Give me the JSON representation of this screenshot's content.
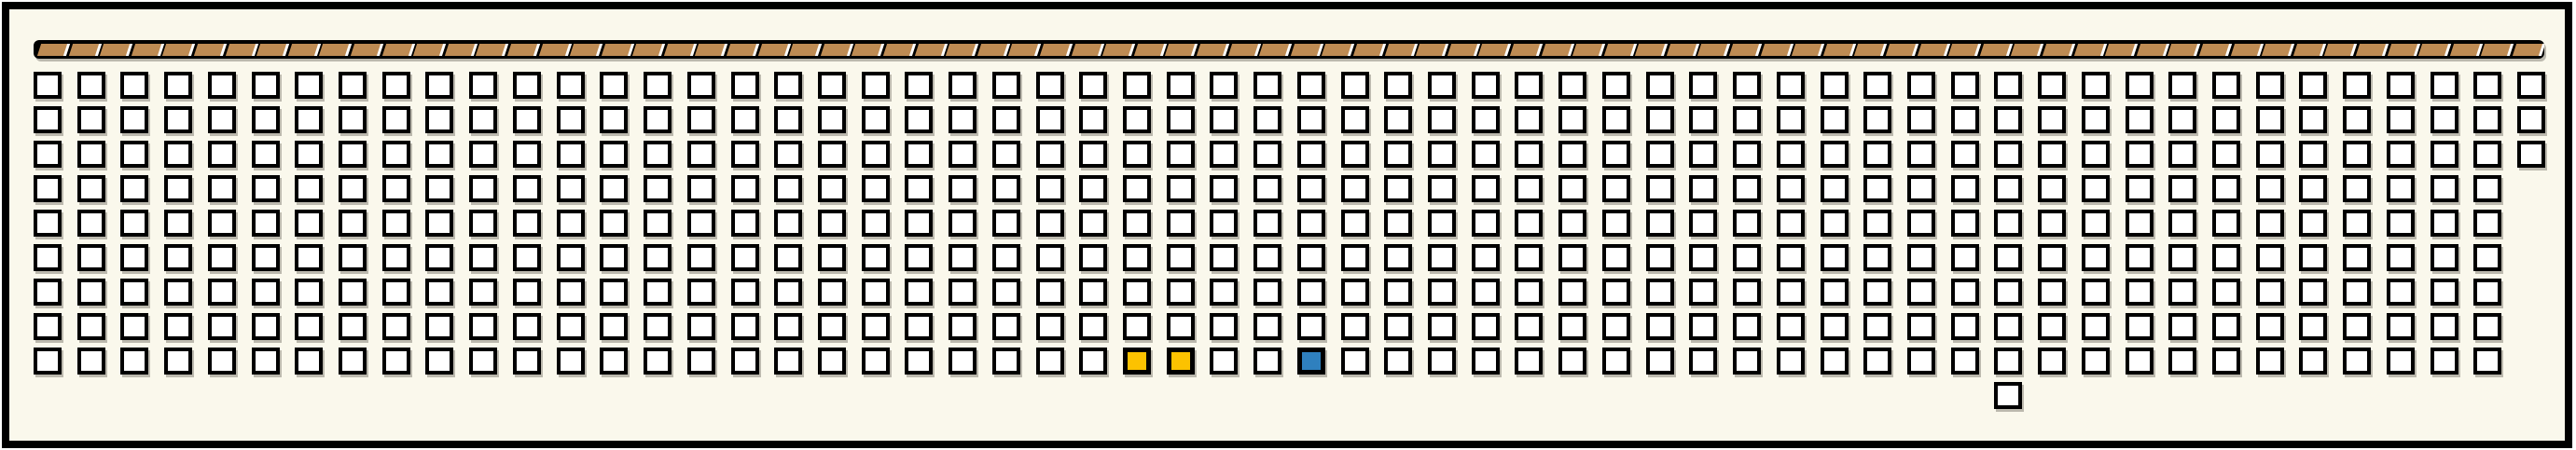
{
  "app": {
    "description": "Seat-map style grid panel with hatched stage bar and selected seats",
    "background_color": "#FFFFFF",
    "panel_color": "#FAF8EC",
    "frame_color": "#000000"
  },
  "stage_bar": {
    "segment_count": 80,
    "segment_color": "#BE8B53",
    "bar_color": "#000000",
    "separator_color": "#FFFFFF"
  },
  "seat_grid": {
    "rows": 9,
    "columns": 58,
    "row_cell_counts": [
      58,
      58,
      58,
      57,
      57,
      57,
      57,
      57,
      57
    ],
    "extra_cell": {
      "row": 10,
      "column": 46
    },
    "cell_fill": "#FFFFFF",
    "cell_border": "#000000",
    "highlighted_cells": [
      {
        "row": 9,
        "column": 26,
        "color": "#FCC200",
        "state": "selected"
      },
      {
        "row": 9,
        "column": 27,
        "color": "#FCC200",
        "state": "selected"
      },
      {
        "row": 9,
        "column": 30,
        "color": "#2F80BE",
        "state": "reserved"
      }
    ],
    "total_cells": 517
  }
}
